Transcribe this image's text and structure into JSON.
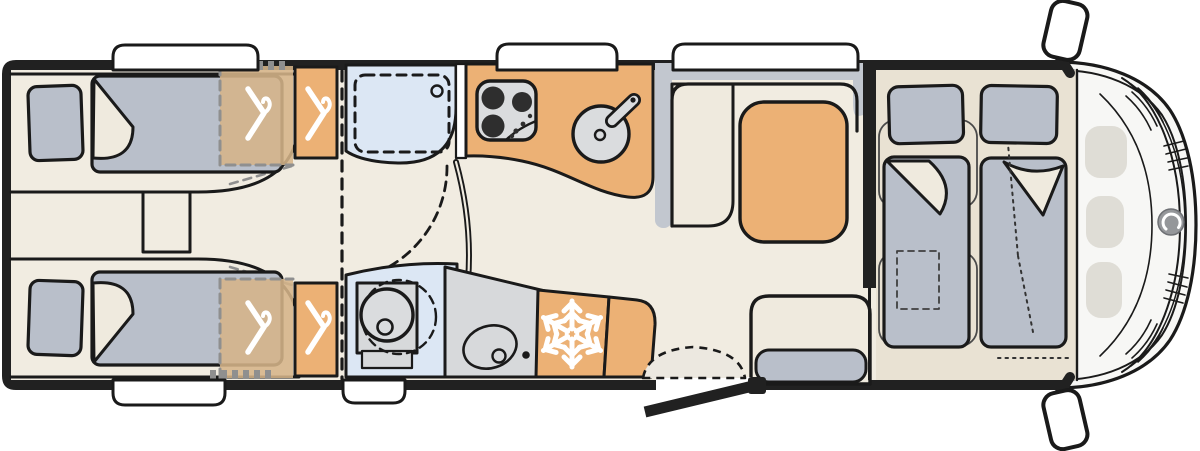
{
  "document": {
    "kind": "motorhome-floor-plan",
    "view": "top-down",
    "cab_position": "right"
  },
  "colors": {
    "wall": "#212121",
    "line": "#1A1A1A",
    "floor": "#F1ECE1",
    "floor_front": "#E9E2D3",
    "cream": "#EFEADE",
    "orange": "#ECB175",
    "tan": "#D5B489",
    "blue": "#DCE7F4",
    "upholstery": "#B9BFCA",
    "panel": "#C2C7CF",
    "appliance": "#D7D9DB",
    "appliance_light": "#DADCDE",
    "faded": "#DFDDD6",
    "cab": "#F7F7F5",
    "window": "#FFFFFF",
    "dash_gray": "#8F8F8F",
    "burner": "#2E2E2E",
    "logo": "#95979A"
  },
  "regions": [
    {
      "id": "rear-bedroom",
      "features": [
        "single-bed-top",
        "single-bed-bottom",
        "bed-step",
        "wardrobe-overlay-top",
        "wardrobe-top",
        "wardrobe-overlay-bottom",
        "wardrobe-bottom"
      ]
    },
    {
      "id": "washroom",
      "features": [
        "shower-cubicle",
        "swivel-toilet",
        "washbasin",
        "washroom-door"
      ]
    },
    {
      "id": "kitchen",
      "features": [
        "hob-3-burner",
        "round-sink",
        "refrigerator",
        "kitchen-cabinet"
      ]
    },
    {
      "id": "lounge",
      "features": [
        "l-shaped-bench",
        "dinette-table",
        "travel-bench"
      ]
    },
    {
      "id": "front-bedroom",
      "features": [
        "drop-down-bed-left",
        "drop-down-bed-right"
      ]
    },
    {
      "id": "entrance",
      "features": [
        "entry-door-open",
        "entry-step"
      ]
    },
    {
      "id": "cab",
      "features": [
        "windscreen",
        "dashboard",
        "brand-logo",
        "side-mirror-top",
        "side-mirror-bottom"
      ]
    }
  ],
  "icons": [
    "hanger-icon",
    "snowflake-icon",
    "hob-icon",
    "sink-icon",
    "faucet-icon",
    "toilet-icon",
    "washbasin-icon",
    "shower-drain-icon",
    "brand-logo-icon",
    "side-mirror-icon",
    "entry-door-icon"
  ],
  "windows": {
    "top_wall": 3,
    "bottom_wall": 2
  }
}
